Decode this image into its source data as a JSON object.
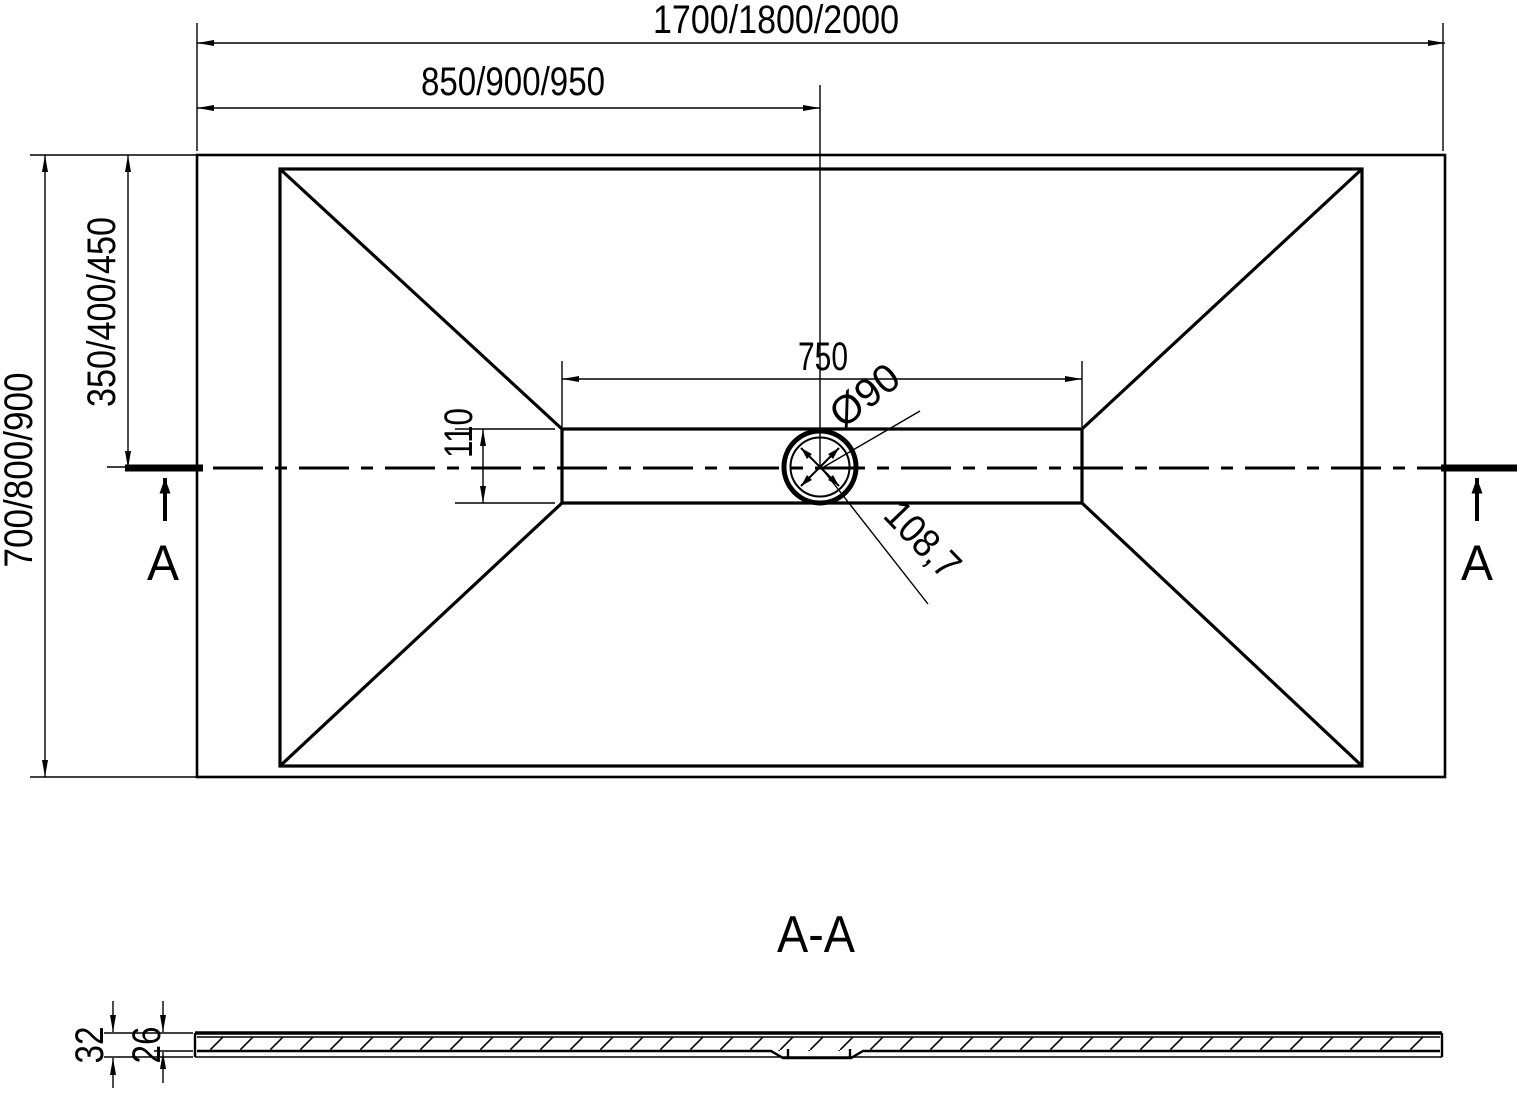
{
  "top_view": {
    "dim_overall_width": "1700/1800/2000",
    "dim_center_width": "850/900/950",
    "dim_overall_depth": "700/800/900",
    "dim_center_depth": "350/400/450",
    "dim_channel_length": "750",
    "dim_channel_width": "110",
    "dim_drain_diameter": "Ø90",
    "dim_drain_diagonal": "108,7",
    "section_marker_left": "A",
    "section_marker_right": "A"
  },
  "section_view": {
    "title": "A-A",
    "dim_total_thickness": "32",
    "dim_base_thickness": "26"
  },
  "colors": {
    "line": "#000000",
    "background": "#ffffff"
  }
}
